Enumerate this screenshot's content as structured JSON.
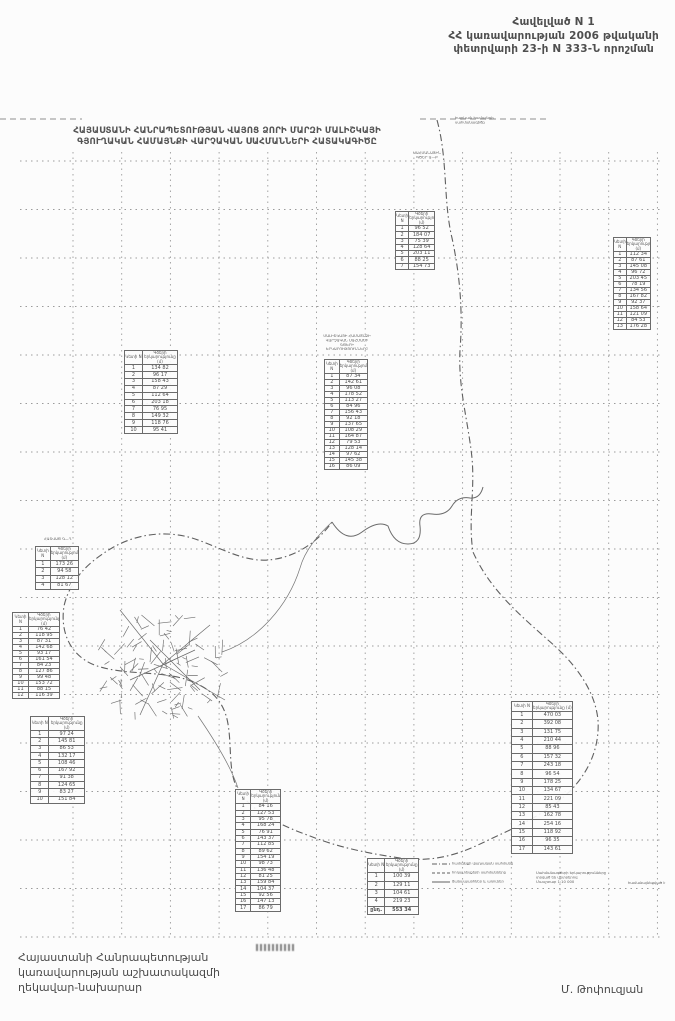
{
  "header": {
    "line1": "Հավելված N 1",
    "line2": "ՀՀ կառավարության 2006 թվականի",
    "line3": "փետրվարի 23-ի N 333-Ն որոշման"
  },
  "map_title": {
    "line1": "ՀԱՅԱՍՏԱՆԻ ՀԱՆՐԱՊԵՏՈՒԹՅԱՆ ՎԱՅՈՑ ՁՈՐԻ ՄԱՐԶԻ ՄԱԼԻՇԿԱՅԻ",
    "line2": "ԳՅՈՒՂԱԿԱՆ ՀԱՄԱՅՆՔԻ ՎԱՐՉԱԿԱՆ ՍԱՀՄԱՆՆԵՐԻ ՀԱՏԱԿԱԳԻԾԸ"
  },
  "signature": {
    "line1": "Հայաստանի Հանրապետության",
    "line2": "կառավարության աշխատակազմի",
    "line3": "ղեկավար-նախարար",
    "name": "Մ. Թոփուզյան"
  },
  "colors": {
    "ink": "#5f5f5f",
    "grid": "#9b9b9b",
    "border": "#6b6b6b"
  },
  "map": {
    "table_headers": {
      "col1": "Կետի N",
      "col2": "Գծերի երկարությունը (մ)"
    },
    "tables": [
      {
        "id": "t1",
        "pos": {
          "x": 395,
          "y": 211,
          "w": 40,
          "h": 59
        },
        "rows": [
          [
            "1",
            "96 52"
          ],
          [
            "2",
            "184 07"
          ],
          [
            "3",
            "75 39"
          ],
          [
            "4",
            "128 64"
          ],
          [
            "5",
            "203 11"
          ],
          [
            "6",
            "88 25"
          ],
          [
            "7",
            "154 73"
          ]
        ]
      },
      {
        "id": "t2",
        "pos": {
          "x": 613,
          "y": 237,
          "w": 38,
          "h": 93
        },
        "rows": [
          [
            "1",
            "112 34"
          ],
          [
            "2",
            "87 61"
          ],
          [
            "3",
            "145 08"
          ],
          [
            "4",
            "96 72"
          ],
          [
            "5",
            "203 45"
          ],
          [
            "6",
            "78 19"
          ],
          [
            "7",
            "134 56"
          ],
          [
            "8",
            "167 82"
          ],
          [
            "9",
            "92 37"
          ],
          [
            "10",
            "158 64"
          ],
          [
            "11",
            "121 09"
          ],
          [
            "12",
            "84 53"
          ],
          [
            "13",
            "176 28"
          ]
        ]
      },
      {
        "id": "t3",
        "pos": {
          "x": 124,
          "y": 350,
          "w": 54,
          "h": 84
        },
        "rows": [
          [
            "1",
            "134 82"
          ],
          [
            "2",
            "96 17"
          ],
          [
            "3",
            "158 43"
          ],
          [
            "4",
            "87 29"
          ],
          [
            "5",
            "112 64"
          ],
          [
            "6",
            "203 18"
          ],
          [
            "7",
            "76 95"
          ],
          [
            "8",
            "149 32"
          ],
          [
            "9",
            "118 76"
          ],
          [
            "10",
            "95 41"
          ]
        ]
      },
      {
        "id": "t4",
        "pos": {
          "x": 324,
          "y": 359,
          "w": 44,
          "h": 110
        },
        "rows": [
          [
            "1",
            "87 34"
          ],
          [
            "2",
            "142 61"
          ],
          [
            "3",
            "96 08"
          ],
          [
            "4",
            "178 52"
          ],
          [
            "5",
            "113 27"
          ],
          [
            "6",
            "84 96"
          ],
          [
            "7",
            "156 43"
          ],
          [
            "8",
            "92 18"
          ],
          [
            "9",
            "137 65"
          ],
          [
            "10",
            "108 29"
          ],
          [
            "11",
            "164 87"
          ],
          [
            "12",
            "79 53"
          ],
          [
            "13",
            "128 14"
          ],
          [
            "14",
            "97 62"
          ],
          [
            "15",
            "145 38"
          ],
          [
            "16",
            "86 09"
          ]
        ]
      },
      {
        "id": "t5",
        "pos": {
          "x": 35,
          "y": 546,
          "w": 44,
          "h": 44
        },
        "rows": [
          [
            "1",
            "173 26"
          ],
          [
            "2",
            "94 58"
          ],
          [
            "3",
            "128 12"
          ],
          [
            "4",
            "81 67"
          ]
        ]
      },
      {
        "id": "t6",
        "pos": {
          "x": 12,
          "y": 612,
          "w": 48,
          "h": 86
        },
        "rows": [
          [
            "1",
            "76 42"
          ],
          [
            "2",
            "118 95"
          ],
          [
            "3",
            "87 31"
          ],
          [
            "4",
            "142 68"
          ],
          [
            "5",
            "93 17"
          ],
          [
            "6",
            "161 54"
          ],
          [
            "7",
            "84 23"
          ],
          [
            "8",
            "127 86"
          ],
          [
            "9",
            "99 48"
          ],
          [
            "10",
            "153 72"
          ],
          [
            "11",
            "88 15"
          ],
          [
            "12",
            "116 39"
          ]
        ]
      },
      {
        "id": "t7",
        "pos": {
          "x": 30,
          "y": 716,
          "w": 55,
          "h": 88
        },
        "rows": [
          [
            "1",
            "97 24"
          ],
          [
            "2",
            "145 81"
          ],
          [
            "3",
            "86 53"
          ],
          [
            "4",
            "132 17"
          ],
          [
            "5",
            "108 46"
          ],
          [
            "6",
            "167 92"
          ],
          [
            "7",
            "91 38"
          ],
          [
            "8",
            "124 65"
          ],
          [
            "9",
            "83 27"
          ],
          [
            "10",
            "151 84"
          ]
        ]
      },
      {
        "id": "t8",
        "pos": {
          "x": 511,
          "y": 701,
          "w": 62,
          "h": 153
        },
        "rows": [
          [
            "1",
            "470 03"
          ],
          [
            "2",
            "392 08"
          ],
          [
            "3",
            "131 75"
          ],
          [
            "4",
            "210 44"
          ],
          [
            "5",
            "88 96"
          ],
          [
            "6",
            "157 32"
          ],
          [
            "7",
            "243 18"
          ],
          [
            "8",
            "96 54"
          ],
          [
            "9",
            "178 25"
          ],
          [
            "10",
            "134 67"
          ],
          [
            "11",
            "221 09"
          ],
          [
            "12",
            "85 43"
          ],
          [
            "13",
            "162 78"
          ],
          [
            "14",
            "254 16"
          ],
          [
            "15",
            "118 92"
          ],
          [
            "16",
            "96 35"
          ],
          [
            "17",
            "143 61"
          ]
        ]
      },
      {
        "id": "t9",
        "pos": {
          "x": 235,
          "y": 789,
          "w": 46,
          "h": 123
        },
        "rows": [
          [
            "1",
            "84 16"
          ],
          [
            "2",
            "127 53"
          ],
          [
            "3",
            "95 78"
          ],
          [
            "4",
            "168 24"
          ],
          [
            "5",
            "76 91"
          ],
          [
            "6",
            "143 37"
          ],
          [
            "7",
            "112 85"
          ],
          [
            "8",
            "89 62"
          ],
          [
            "9",
            "154 19"
          ],
          [
            "10",
            "98 73"
          ],
          [
            "11",
            "136 48"
          ],
          [
            "12",
            "81 25"
          ],
          [
            "13",
            "159 84"
          ],
          [
            "14",
            "104 37"
          ],
          [
            "15",
            "92 56"
          ],
          [
            "16",
            "147 13"
          ],
          [
            "17",
            "86 79"
          ]
        ]
      },
      {
        "id": "t10",
        "pos": {
          "x": 367,
          "y": 858,
          "w": 52,
          "h": 57
        },
        "rows": [
          [
            "1",
            "100 39"
          ],
          [
            "2",
            "129 11"
          ],
          [
            "3",
            "104 61"
          ],
          [
            "4",
            "219 23"
          ]
        ],
        "total": [
          "ընդ.",
          "553 34"
        ]
      }
    ],
    "notes": [
      {
        "x": 404,
        "y": 151,
        "w": 46,
        "align": "center",
        "lines": [
          "ՍԱՀՄԱՆԱՅԻՆ",
          "ԳԾԵՐ Ա—Բ"
        ]
      },
      {
        "x": 455,
        "y": 116,
        "w": 58,
        "align": "left",
        "lines": [
          "հարևան համայնքի",
          "սահմանագիծը"
        ]
      },
      {
        "x": 321,
        "y": 334,
        "w": 52,
        "align": "center",
        "lines": [
          "ՄԱԼԻՇԿԱՅԻ ՀԱՄԱՅՆՔԻ",
          "ՎԱՐՉԱԿԱՆ ՍԱՀՄԱՆԻ",
          "ԳԾԵՐԻ",
          "ԵՐԿԱՐՈՒԹՅՈՒՆՆԵՐԸ"
        ]
      },
      {
        "x": 44,
        "y": 537,
        "w": 40,
        "align": "left",
        "lines": [
          "ՀԱՏՎԱԾ Գ—Դ"
        ]
      },
      {
        "x": 536,
        "y": 871,
        "w": 72,
        "align": "left",
        "lines": [
          "Սահմանագծերի երկարությունները",
          "տրված են մետրերով",
          "Մասշտաբ 1:10 000"
        ]
      },
      {
        "x": 628,
        "y": 881,
        "w": 38,
        "align": "left",
        "lines": [
          "համաձայնեցված է"
        ]
      }
    ],
    "legend": {
      "x": 432,
      "y": 859,
      "entries": [
        {
          "style": "dashdot",
          "label": "համայնքի վարչական սահմանը"
        },
        {
          "style": "dashed",
          "label": "հողատեսքերի սահմանները"
        },
        {
          "style": "solid",
          "label": "ճանապարհներ և առուներ"
        }
      ]
    }
  }
}
